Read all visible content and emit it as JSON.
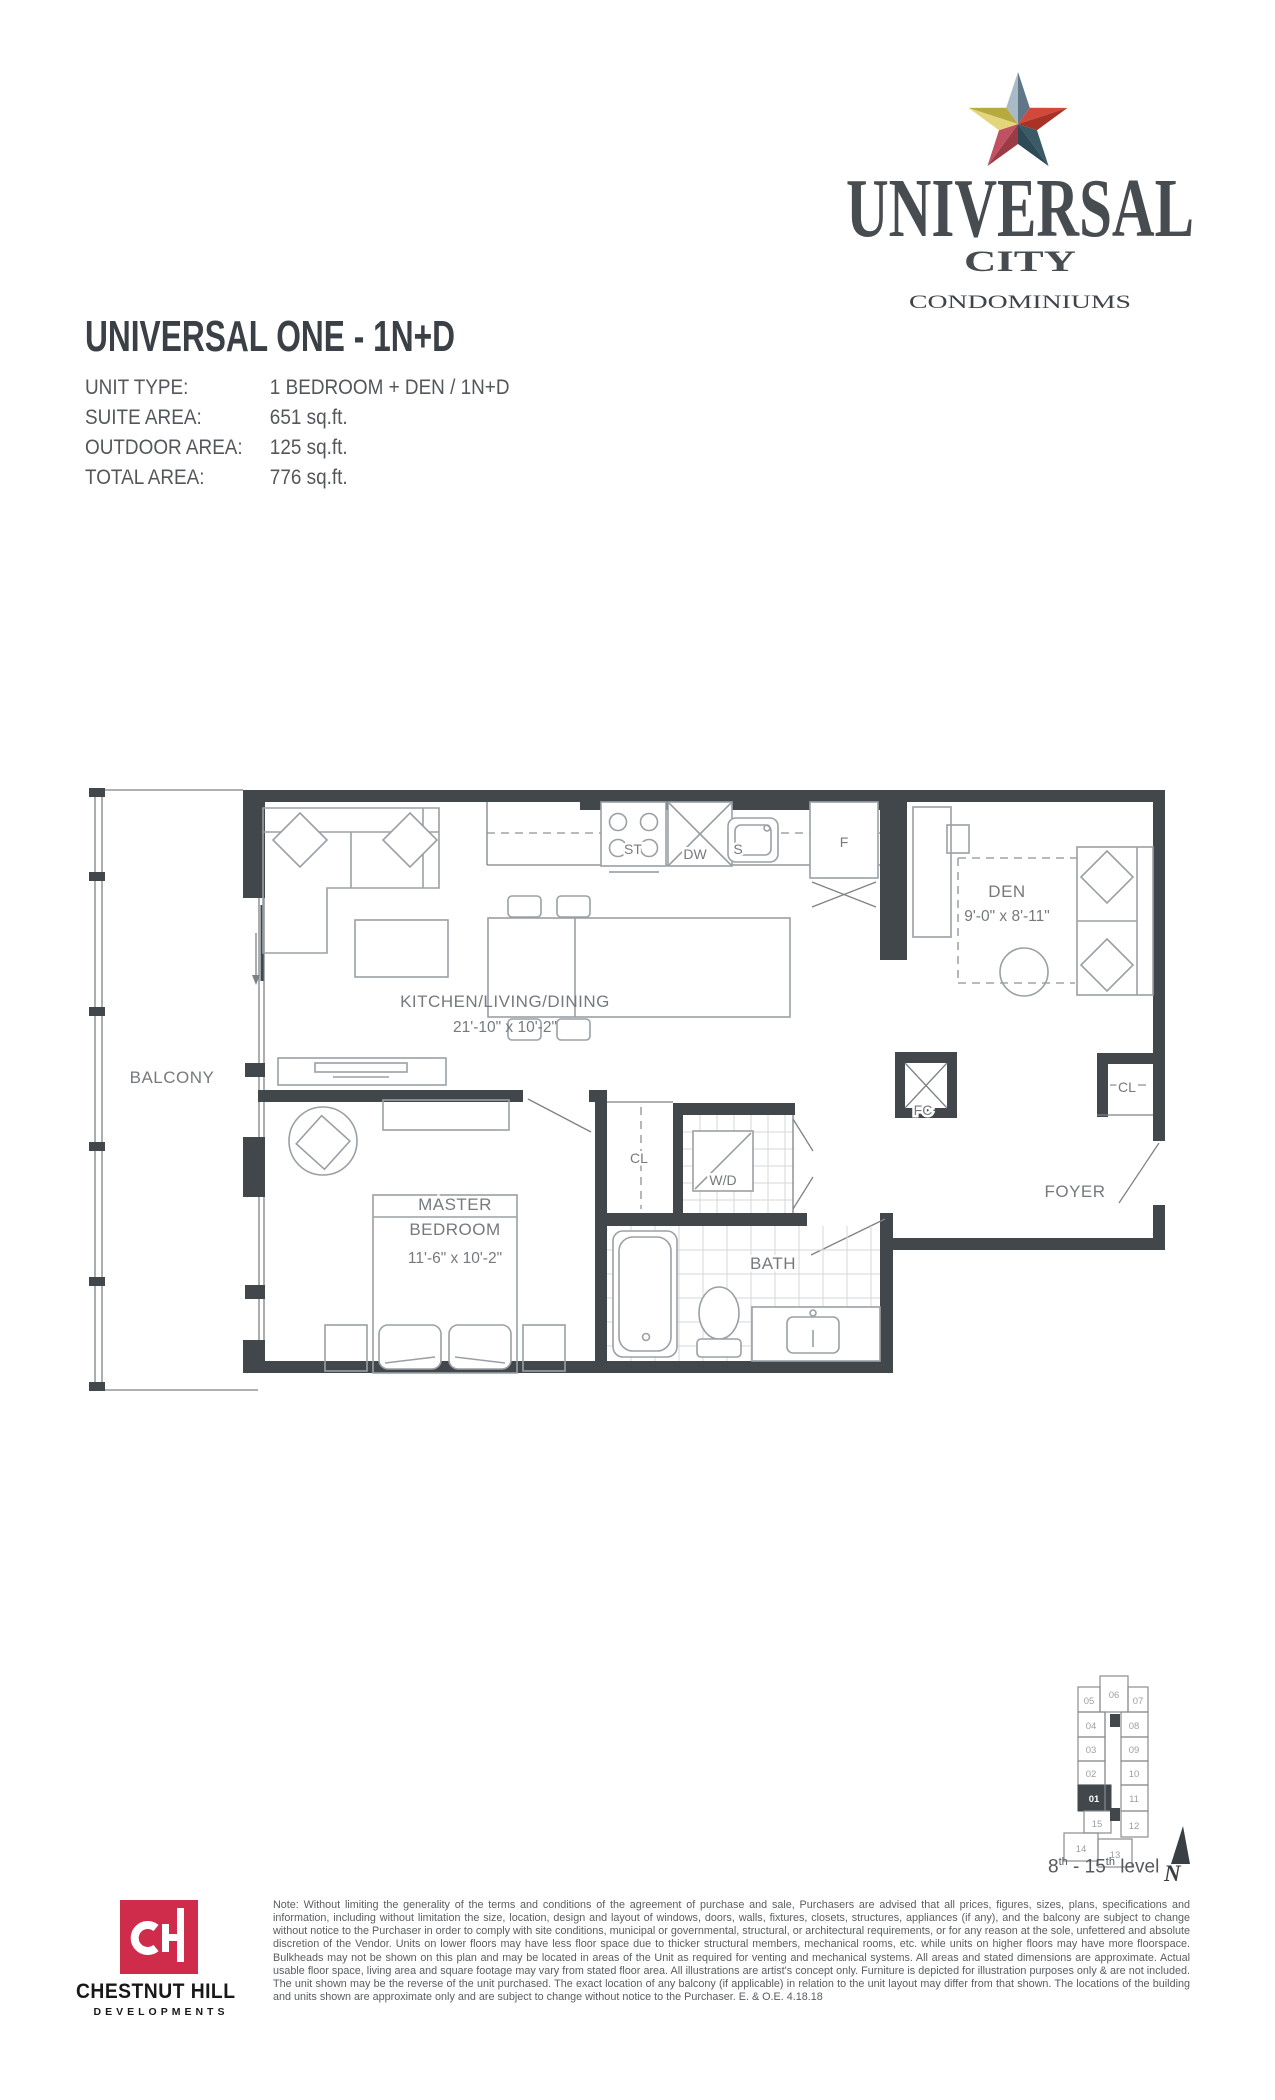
{
  "logo": {
    "name": "UNIVERSAL",
    "city": "CITY",
    "tagline": "CONDOMINIUMS"
  },
  "header": {
    "title": "UNIVERSAL ONE - 1N+D"
  },
  "unit_info": {
    "rows": [
      {
        "label": "UNIT TYPE:",
        "value": "1 BEDROOM + DEN / 1N+D"
      },
      {
        "label": "SUITE AREA:",
        "value": "651 sq.ft."
      },
      {
        "label": "OUTDOOR AREA:",
        "value": "125 sq.ft."
      },
      {
        "label": "TOTAL AREA:",
        "value": "776 sq.ft."
      }
    ]
  },
  "floorplan": {
    "labels": {
      "balcony": "BALCONY",
      "kitchen_name": "KITCHEN/LIVING/DINING",
      "kitchen_dims": "21'-10\" x 10'-2\"",
      "master_line1": "MASTER",
      "master_line2": "BEDROOM",
      "master_dims": "11'-6\" x 10'-2\"",
      "den_name": "DEN",
      "den_dims": "9'-0\" x 8'-11\"",
      "bath": "BATH",
      "foyer": "FOYER",
      "wd": "W/D",
      "fc": "FC",
      "cl_hall": "CL",
      "cl_foyer": "CL",
      "stove": "ST",
      "dishwasher": "DW",
      "sink": "S",
      "fridge": "F"
    },
    "colors": {
      "wall": "#42474c",
      "furniture_line": "#9aa0a5",
      "label_gray": "#76797d"
    }
  },
  "keyplan": {
    "units": [
      "05",
      "06",
      "07",
      "04",
      "08",
      "03",
      "09",
      "02",
      "10",
      "01",
      "11",
      "15",
      "12",
      "14",
      "13"
    ],
    "highlighted_unit": "01",
    "caption": {
      "b1": "8",
      "s1": "th",
      "b2": " - 15",
      "s2": "th",
      "b3": " level"
    },
    "north": "N"
  },
  "developer": {
    "monogram": "cH",
    "name": "CHESTNUT HILL",
    "division": "DEVELOPMENTS",
    "brand_red": "#cf2c4c"
  },
  "logo_star_colors": {
    "top_light": "#a9bac7",
    "top_dark": "#5e7687",
    "right_light": "#d1493b",
    "right_dark": "#a93226",
    "bottom_right_light": "#3c5a66",
    "bottom_right_dark": "#2e4a56",
    "bottom_left_dark": "#9c3a46",
    "bottom_left_light": "#c05160",
    "left_light": "#e2d57b",
    "left_dark": "#b6a93e"
  },
  "disclaimer": "Note: Without limiting the generality of the terms and conditions of the agreement of purchase and sale, Purchasers are advised that all prices, figures, sizes, plans, specifications and information, including without limitation the size, location, design and layout of windows, doors, walls, fixtures, closets, structures, appliances (if any), and the balcony are subject to change without notice to the Purchaser in order to comply with site conditions, municipal or governmental, structural, or architectural requirements, or for any reason at the sole, unfettered and absolute discretion of the Vendor. Units on lower floors may have less floor space due to thicker structural members, mechanical rooms, etc. while units on higher floors may have more floorspace. Bulkheads may not be shown on this plan and may be located in areas of the Unit as required for venting and mechanical systems. All areas and stated dimensions are approximate. Actual usable floor space, living area and square footage may vary from stated floor area. All illustrations are artist's concept only. Furniture is depicted for illustration purposes only & are not included. The unit shown may be the reverse of the unit purchased. The exact location of any balcony (if applicable) in relation to the unit layout may differ from that shown. The locations of the building and units shown are approximate only and are subject to change without notice to the Purchaser. E. & O.E. 4.18.18"
}
